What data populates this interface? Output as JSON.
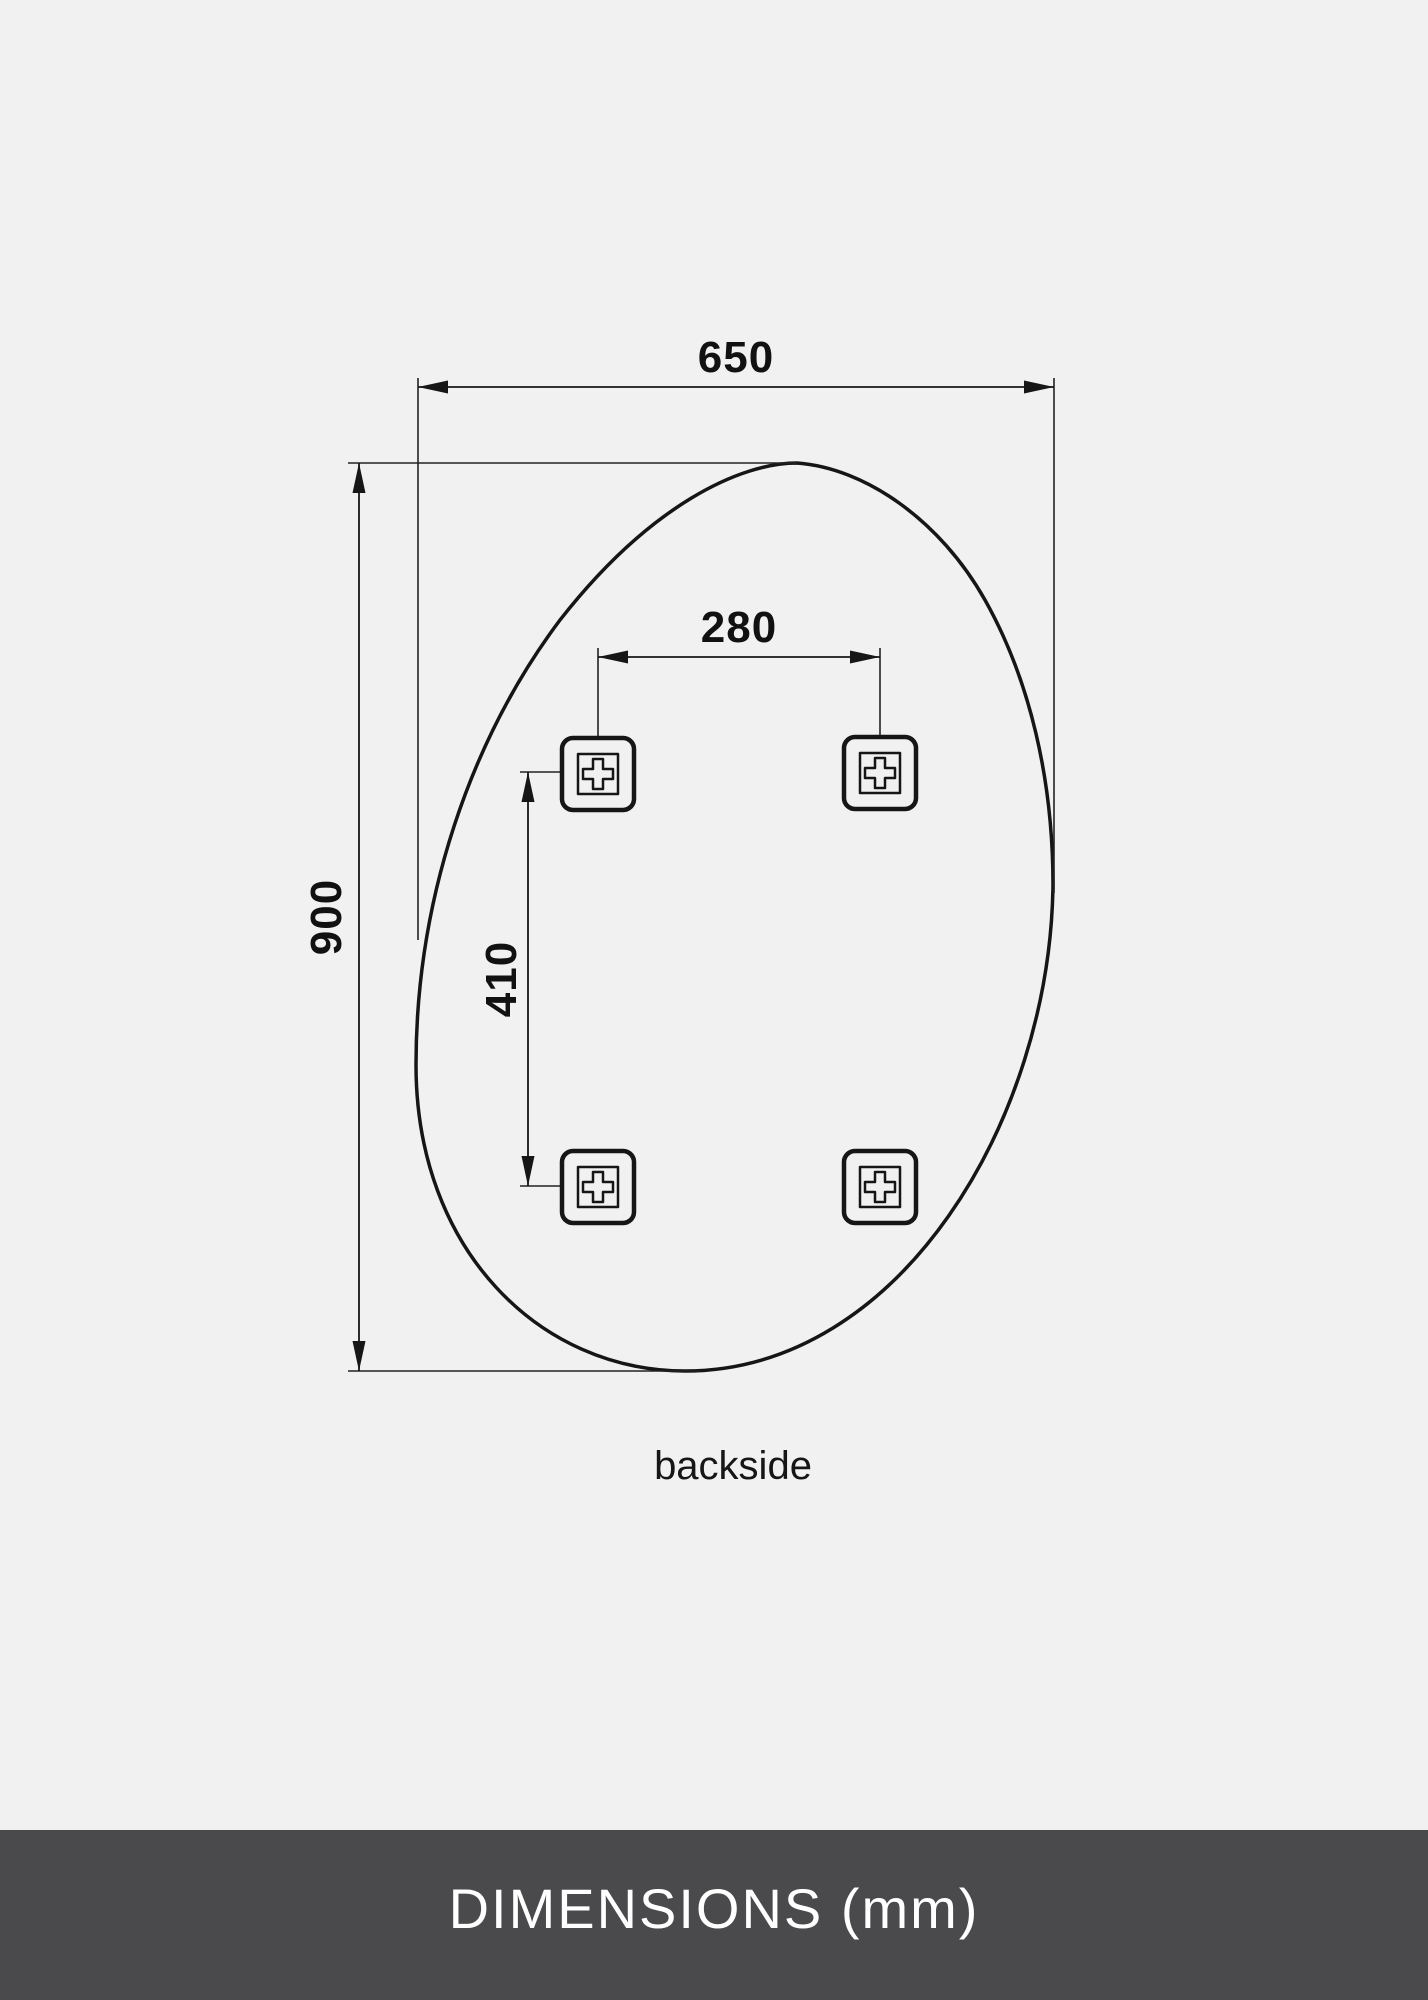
{
  "diagram": {
    "type": "product-dimension-drawing",
    "subject": "organic teardrop mirror, rear view",
    "caption": "backside",
    "dimensions": {
      "overall_width_mm": "650",
      "overall_height_mm": "900",
      "bracket_spacing_horizontal_mm": "280",
      "bracket_spacing_vertical_mm": "410"
    },
    "bracket_count": 4,
    "colors": {
      "background": "#f1f1f1",
      "line": "#161616",
      "footer_background": "#4a4a4c",
      "footer_text": "#ffffff"
    }
  },
  "footer": {
    "title": "DIMENSIONS (mm)"
  }
}
